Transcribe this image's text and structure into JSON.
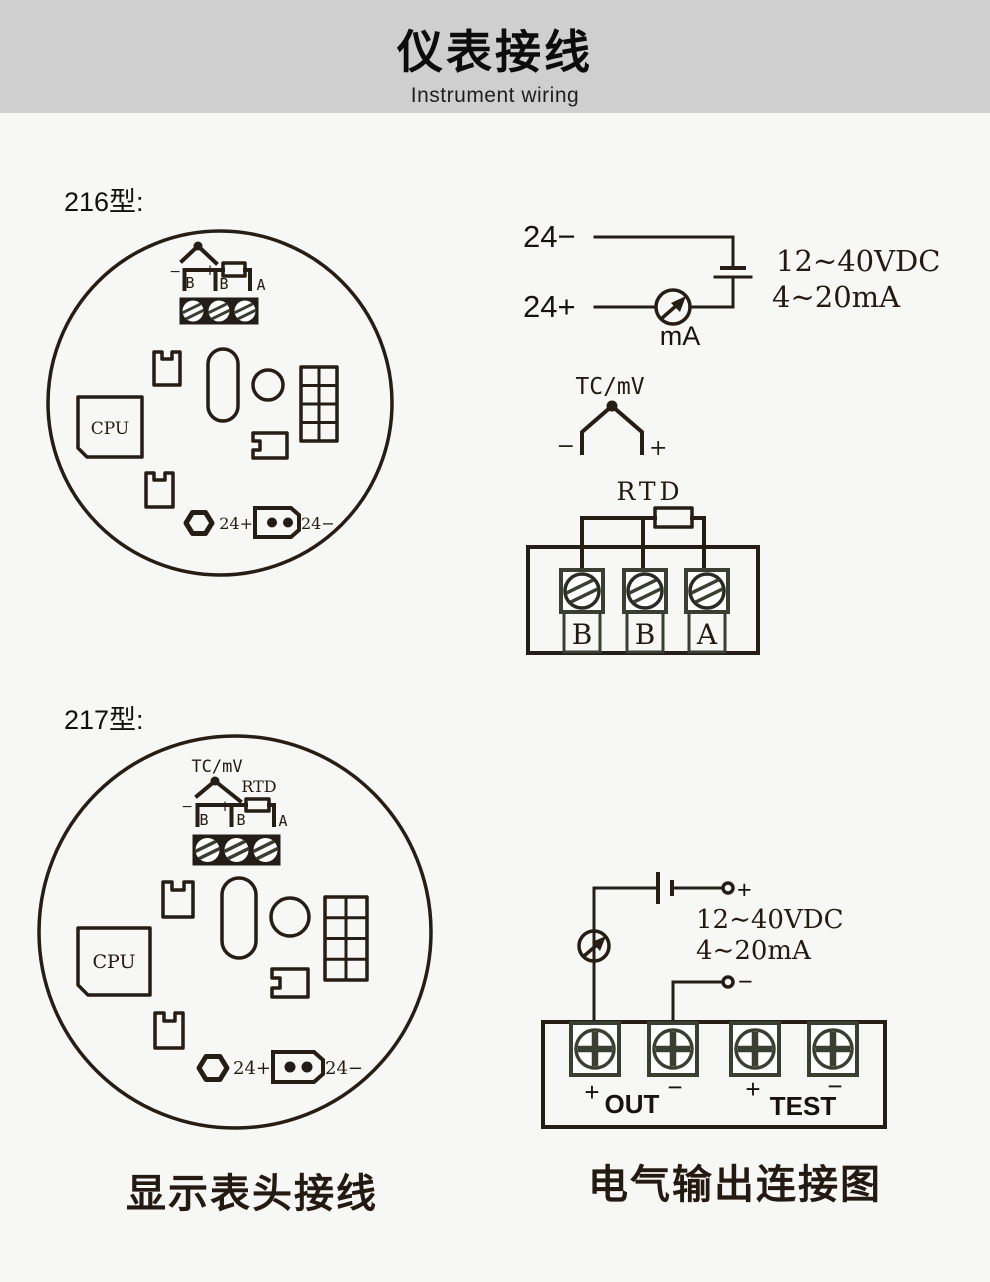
{
  "header": {
    "title": "仪表接线",
    "subtitle": "Instrument wiring"
  },
  "sections": {
    "m216": {
      "label": "216型:"
    },
    "m217": {
      "label": "217型:"
    }
  },
  "board216": {
    "neg": "−",
    "b1": "B",
    "pos": "+",
    "b2": "B",
    "a": "A",
    "cpu": "CPU",
    "p24": "24+",
    "n24": "24−"
  },
  "circuit216": {
    "neg": "24−",
    "pos": "24+",
    "meter": "mA",
    "spec_v": "12∼40VDC",
    "spec_i": "4∼20mA",
    "tc_title": "TC/mV",
    "tc_neg": "−",
    "tc_pos": "+",
    "rtd_title": "RTD",
    "t1": "B",
    "t2": "B",
    "t3": "A"
  },
  "board217": {
    "tc_title": "TC/mV",
    "rtd_title": "RTD",
    "neg": "−",
    "b1": "B",
    "pos": "+",
    "b2": "B",
    "a": "A",
    "cpu": "CPU",
    "p24": "24+",
    "n24": "24−"
  },
  "circuit217": {
    "spec_v": "12∼40VDC",
    "spec_i": "4∼20mA",
    "src_pos": "+",
    "src_neg": "−",
    "out_pos": "+",
    "out": "OUT",
    "out_neg": "−",
    "test_pos": "+",
    "test": "TEST",
    "test_neg": "−"
  },
  "captions": {
    "left": "显示表头接线",
    "right": "电气输出连接图"
  }
}
